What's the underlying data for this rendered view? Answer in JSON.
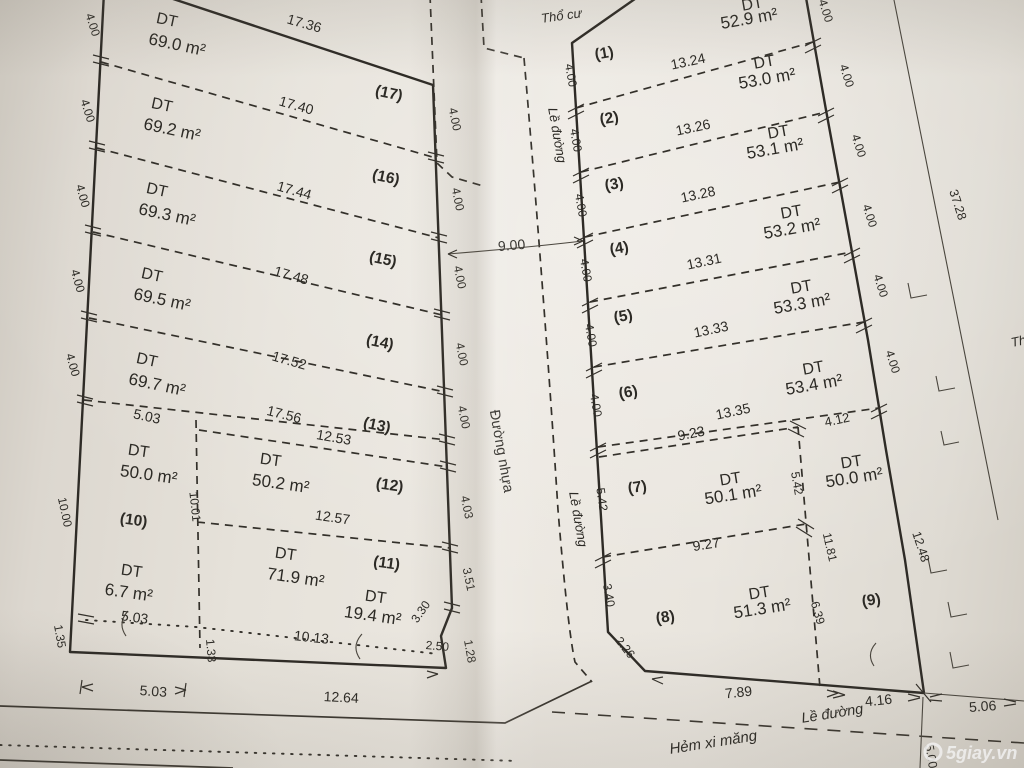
{
  "watermark": {
    "text": "5giay.vn"
  },
  "road": {
    "tho_cu": "Thổ cư",
    "tho_cu_right": "Th",
    "le_duong_top": "Lề đường",
    "le_duong_mid": "Lề đường",
    "le_duong_bottom": "Lề đường",
    "duong_nhua": "Đường nhựa",
    "hem_xi_mang": "Hẻm xi măng",
    "width_dim": "9.00"
  },
  "left_block": {
    "width_dims": [
      "17.36",
      "17.40",
      "17.44",
      "17.48",
      "17.52",
      "17.56"
    ],
    "left_side_dims": [
      "4.00",
      "4.00",
      "4.00",
      "4.00",
      "4.00"
    ],
    "right_side_dims": [
      "4.00",
      "4.00",
      "4.00",
      "4.00",
      "4.00"
    ],
    "lot17": {
      "id": "(17)",
      "dt": "DT",
      "area": "69.0 m²"
    },
    "lot16": {
      "id": "(16)",
      "dt": "DT",
      "area": "69.2 m²"
    },
    "lot15": {
      "id": "(15)",
      "dt": "DT",
      "area": "69.3 m²"
    },
    "lot14": {
      "id": "(14)",
      "dt": "DT",
      "area": "69.5 m²"
    },
    "lot13": {
      "id": "(13)",
      "dt": "DT",
      "area": "69.7 m²"
    },
    "lot10": {
      "id": "(10)",
      "dt": "DT",
      "area": "50.0 m²",
      "height": "10.00"
    },
    "lot12": {
      "id": "(12)",
      "dt": "DT",
      "area": "50.2 m²",
      "top": "12.53",
      "bottom": "12.57",
      "side": "4.03"
    },
    "lot11": {
      "id": "(11)",
      "dt": "DT",
      "area": "71.9 m²",
      "side": "3.51"
    },
    "lot_6_7": {
      "dt": "DT",
      "area": "6.7 m²"
    },
    "lot_19_4": {
      "dt": "DT",
      "area": "19.4 m²"
    },
    "dims": {
      "inner_5_03": "5.03",
      "inner_10_01": "10.01",
      "dotted_5_03": "5.03",
      "dotted_10_13": "10.13",
      "d2_50": "2.50",
      "d3_30": "3.30",
      "d1_33": "1.33",
      "d1_35": "1.35",
      "d1_28": "1.28",
      "bottom_5_03": "5.03",
      "bottom_12_64": "12.64"
    }
  },
  "right_block": {
    "width_dims": [
      "13.24",
      "13.26",
      "13.28",
      "13.31",
      "13.33",
      "13.35"
    ],
    "left_side_dims": [
      "4.00",
      "4.00",
      "4.00",
      "4.00",
      "4.00",
      "4.00"
    ],
    "right_side_dims": [
      "4.00",
      "4.00",
      "4.00",
      "4.00",
      "4.00"
    ],
    "lot1": {
      "id": "(1)",
      "dt": "DT",
      "area": "52.9 m²"
    },
    "lot2": {
      "id": "(2)",
      "dt": "DT",
      "area": "53.0 m²"
    },
    "lot3": {
      "id": "(3)",
      "dt": "DT",
      "area": "53.1 m²"
    },
    "lot4": {
      "id": "(4)",
      "dt": "DT",
      "area": "53.2 m²"
    },
    "lot5": {
      "id": "(5)",
      "dt": "DT",
      "area": "53.3 m²"
    },
    "lot6": {
      "id": "(6)",
      "dt": "DT",
      "area": "53.4 m²"
    },
    "lot7": {
      "id": "(7)",
      "dt": "DT",
      "area": "50.1 m²",
      "side": "5.42"
    },
    "lot8": {
      "id": "(8)",
      "dt": "DT",
      "area": "51.3 m²",
      "side": "3.40",
      "bevel": "2.26"
    },
    "lot9": {
      "id": "(9)",
      "dt": "DT",
      "area": "50.0 m²"
    },
    "dims": {
      "w9_23": "9.23",
      "w9_27": "9.27",
      "w4_12": "4.12",
      "v5_42": "5.42",
      "v11_81": "11.81",
      "v6_39": "6.39",
      "r12_48": "12.48",
      "r4_00_top": "4.00",
      "bottom_7_89": "7.89",
      "bottom_4_16": "4.16",
      "right_5_06": "5.06",
      "right_5_00": "5.00",
      "boundary_37_28": "37.28"
    }
  }
}
